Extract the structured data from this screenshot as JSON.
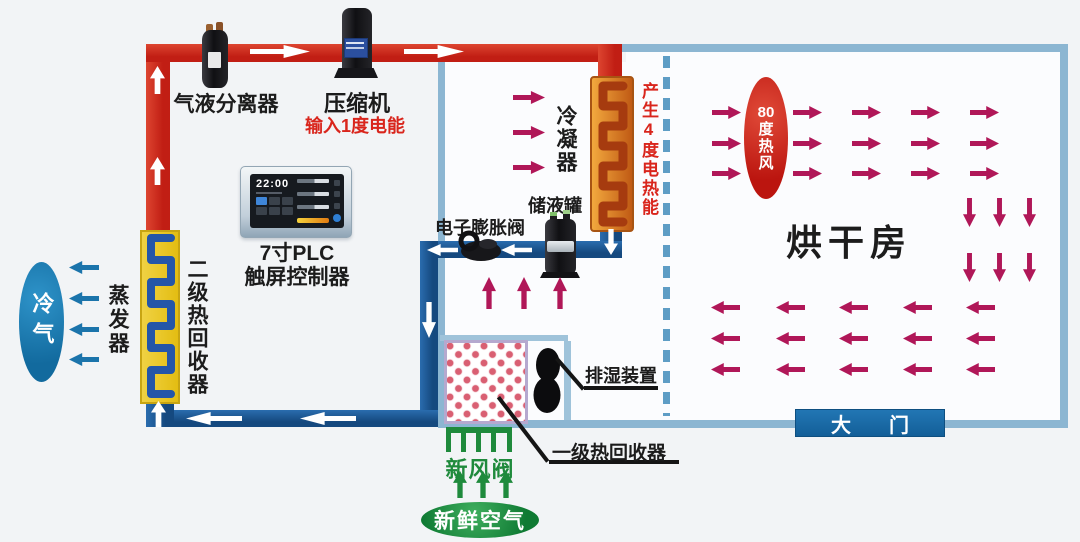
{
  "labels": {
    "separator": "气液分离器",
    "compressor": "压缩机",
    "compressor_input": "输入1度电能",
    "condenser": "冷凝器",
    "heat_output": "产生4度电热能",
    "receiver": "储液罐",
    "expansion_valve": "电子膨胀阀",
    "plc_lines": [
      "7寸PLC",
      "触屏控制器"
    ],
    "evaporator": "蒸发器",
    "recovery_secondary": "二级热回收器",
    "cold_air": "冷气",
    "hot_air_lines": [
      "80",
      "度",
      "热",
      "风"
    ],
    "drying_room": "烘干房",
    "door_chars": [
      "大",
      "门"
    ],
    "dehumidifier": "排湿装置",
    "recovery_primary": "一级热回收器",
    "fresh_air_valve": "新风阀",
    "fresh_air": "新鲜空气"
  },
  "plc_screen": {
    "time": "22:00"
  },
  "colors": {
    "pipe_hot": "#c11e14",
    "pipe_cold": "#15497f",
    "structure_blue": "#8cb6d2",
    "heat_arrow": "#b01758",
    "cold_arrow": "#1b74ab",
    "fresh_green": "#1f8a3c",
    "door_blue": "#135f98",
    "coil_yellow": "#e3bd12",
    "coil_orange": "#c05a14"
  },
  "arrows": [
    {
      "name": "hot-refrigerant-flow",
      "dir": "right",
      "color": "#ffffff",
      "w": 60,
      "h": 13,
      "pts": [
        [
          250,
          45
        ],
        [
          404,
          45
        ]
      ]
    },
    {
      "name": "hot-refrigerant-flow",
      "dir": "up",
      "color": "#ffffff",
      "w": 15,
      "h": 28,
      "pts": [
        [
          150,
          66
        ],
        [
          150,
          157
        ]
      ]
    },
    {
      "name": "liquid-refrigerant-flow",
      "dir": "left",
      "color": "#ffffff",
      "w": 31,
      "h": 12,
      "pts": [
        [
          427,
          244
        ],
        [
          501,
          244
        ]
      ]
    },
    {
      "name": "liquid-refrigerant-flow",
      "dir": "down",
      "color": "#ffffff",
      "w": 14,
      "h": 26,
      "pts": [
        [
          604,
          229
        ]
      ]
    },
    {
      "name": "liquid-refrigerant-flow",
      "dir": "down",
      "color": "#ffffff",
      "w": 14,
      "h": 36,
      "pts": [
        [
          422,
          302
        ]
      ]
    },
    {
      "name": "liquid-refrigerant-flow",
      "dir": "left",
      "color": "#ffffff",
      "w": 56,
      "h": 13,
      "pts": [
        [
          186,
          412
        ],
        [
          300,
          412
        ]
      ]
    },
    {
      "name": "liquid-refrigerant-flow",
      "dir": "up",
      "color": "#ffffff",
      "w": 15,
      "h": 26,
      "pts": [
        [
          151,
          401
        ]
      ]
    },
    {
      "name": "cold-air-out",
      "dir": "left",
      "color": "#1b74ab",
      "w": 30,
      "h": 13,
      "pts": [
        [
          69,
          261
        ],
        [
          69,
          292
        ],
        [
          69,
          323
        ],
        [
          69,
          353
        ]
      ]
    },
    {
      "name": "condenser-heat",
      "dir": "right",
      "color": "#b01758",
      "w": 32,
      "h": 13,
      "pts": [
        [
          513,
          91
        ],
        [
          513,
          126
        ],
        [
          513,
          161
        ]
      ]
    },
    {
      "name": "recovered-heat",
      "dir": "up",
      "color": "#b01758",
      "w": 14,
      "h": 32,
      "pts": [
        [
          482,
          277
        ],
        [
          517,
          277
        ],
        [
          553,
          277
        ]
      ]
    },
    {
      "name": "hot-air-flow",
      "dir": "right",
      "color": "#b01758",
      "w": 29,
      "h": 13,
      "pts": [
        [
          712,
          106
        ],
        [
          712,
          137
        ],
        [
          712,
          167
        ],
        [
          793,
          106
        ],
        [
          793,
          137
        ],
        [
          793,
          167
        ],
        [
          852,
          106
        ],
        [
          852,
          137
        ],
        [
          852,
          167
        ],
        [
          911,
          106
        ],
        [
          911,
          137
        ],
        [
          911,
          167
        ],
        [
          970,
          106
        ],
        [
          970,
          137
        ],
        [
          970,
          167
        ]
      ]
    },
    {
      "name": "hot-air-flow",
      "dir": "down",
      "color": "#b01758",
      "w": 13,
      "h": 29,
      "pts": [
        [
          963,
          198
        ],
        [
          993,
          198
        ],
        [
          1023,
          198
        ],
        [
          963,
          253
        ],
        [
          993,
          253
        ],
        [
          1023,
          253
        ]
      ]
    },
    {
      "name": "hot-air-flow",
      "dir": "left",
      "color": "#b01758",
      "w": 29,
      "h": 13,
      "pts": [
        [
          711,
          301
        ],
        [
          776,
          301
        ],
        [
          839,
          301
        ],
        [
          903,
          301
        ],
        [
          966,
          301
        ],
        [
          711,
          332
        ],
        [
          776,
          332
        ],
        [
          839,
          332
        ],
        [
          903,
          332
        ],
        [
          966,
          332
        ],
        [
          711,
          363
        ],
        [
          776,
          363
        ],
        [
          839,
          363
        ],
        [
          903,
          363
        ],
        [
          966,
          363
        ]
      ]
    },
    {
      "name": "fresh-air-in",
      "dir": "up",
      "color": "#1f8a3c",
      "w": 14,
      "h": 27,
      "pts": [
        [
          453,
          471
        ],
        [
          476,
          471
        ],
        [
          499,
          471
        ]
      ]
    }
  ]
}
